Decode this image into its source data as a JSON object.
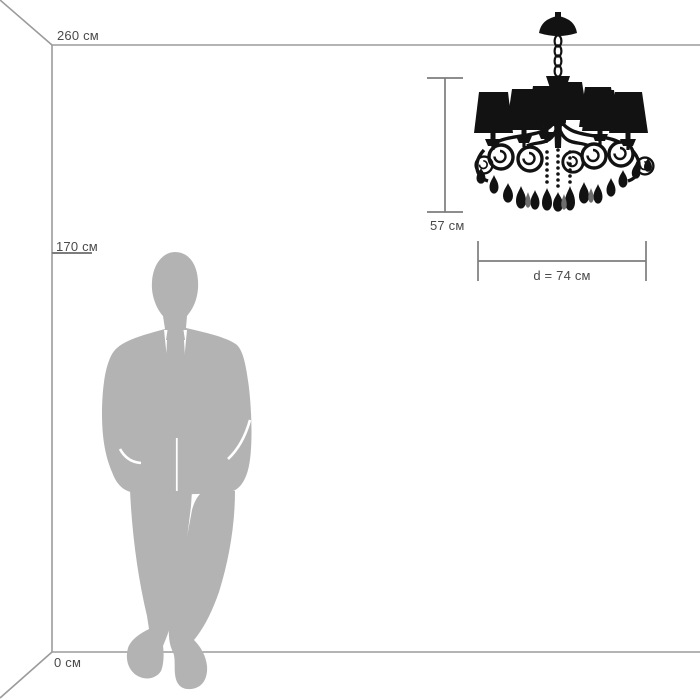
{
  "scale_diagram": {
    "ceiling": {
      "label": "260 см",
      "value_cm": 260
    },
    "person": {
      "label": "170 см",
      "value_cm": 170,
      "figure": "man-silhouette"
    },
    "floor": {
      "label": "0 см",
      "value_cm": 0
    },
    "product": {
      "type": "chandelier-silhouette",
      "height": {
        "label": "57 см",
        "value_cm": 57
      },
      "diameter": {
        "label": "d = 74 см",
        "value_cm": 74
      }
    },
    "colors": {
      "background": "#ffffff",
      "room_lines": "#9b9b9b",
      "dimension_lines": "#7d7d7d",
      "text": "#4a4a4a",
      "person_silhouette": "#b3b3b3",
      "product_silhouette": "#121212"
    }
  }
}
